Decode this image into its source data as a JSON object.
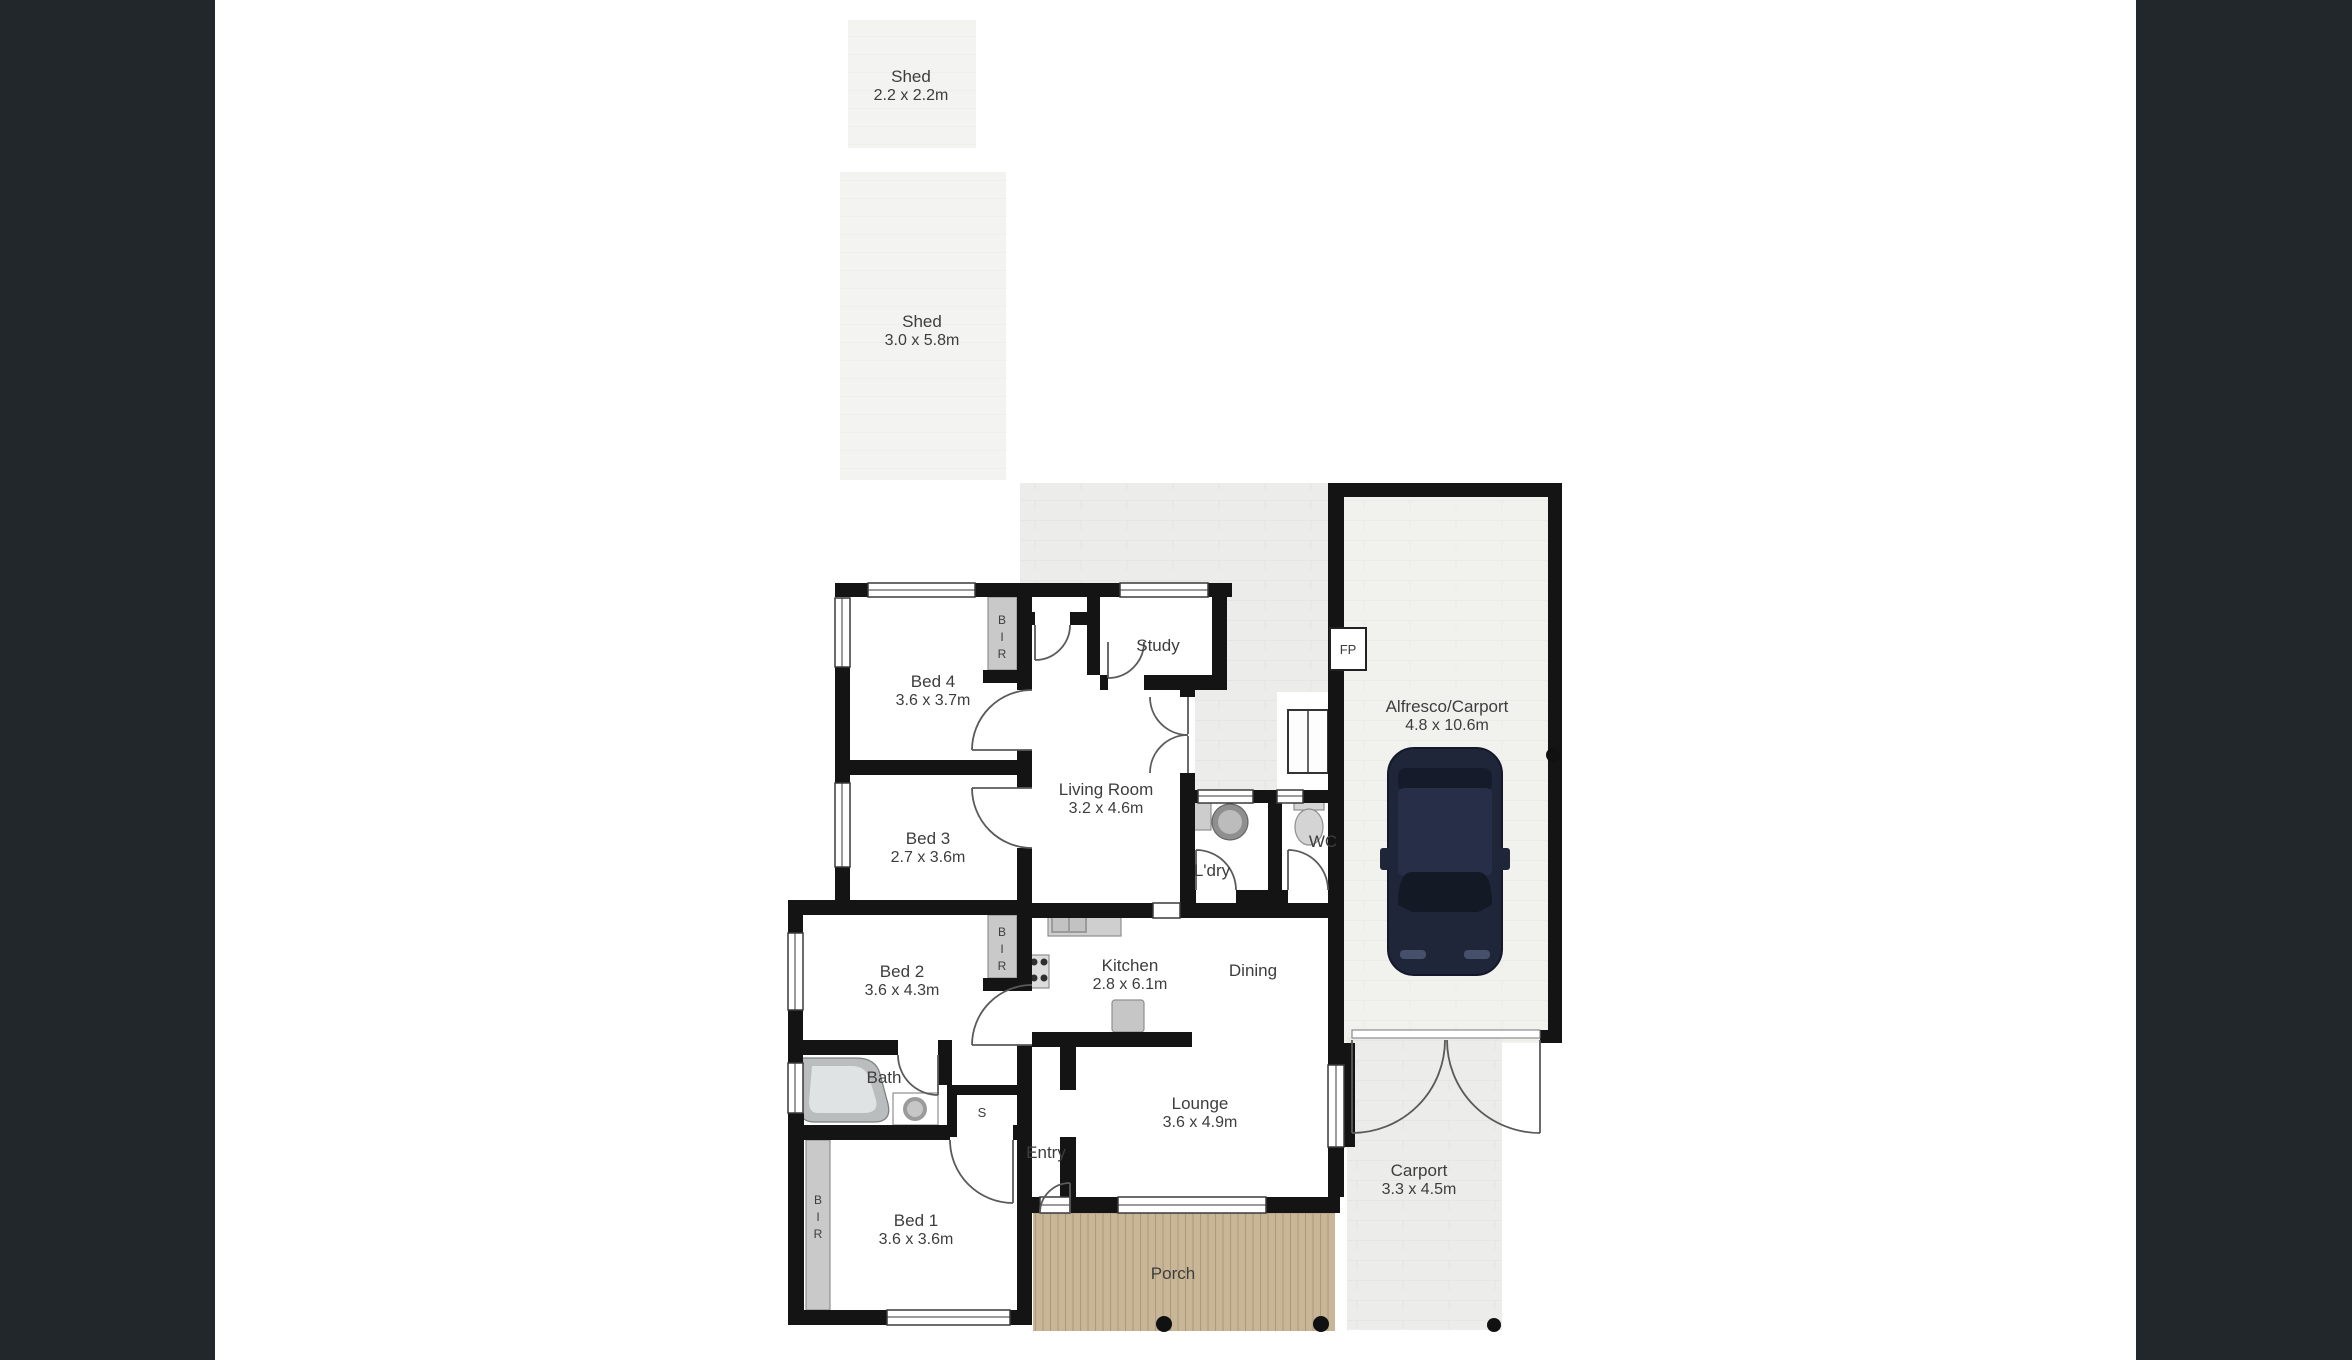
{
  "palette": {
    "sidebar": "#22272b",
    "wall": "#141414",
    "page": "#ffffff",
    "courtyard": "#ececea",
    "alfresco_floor": "#f1f1ee",
    "shed_floor": "#f3f3f1",
    "deck": "#c9b696",
    "deck_line": "#ae9d7f",
    "label_text": "#3d3d3d",
    "car_body": "#20263a"
  },
  "labels": {
    "shed_small": {
      "name": "Shed",
      "dims": "2.2 x 2.2m"
    },
    "shed_large": {
      "name": "Shed",
      "dims": "3.0 x 5.8m"
    },
    "bed1": {
      "name": "Bed 1",
      "dims": "3.6 x 3.6m"
    },
    "bed2": {
      "name": "Bed 2",
      "dims": "3.6 x 4.3m"
    },
    "bed3": {
      "name": "Bed 3",
      "dims": "2.7 x 3.6m"
    },
    "bed4": {
      "name": "Bed 4",
      "dims": "3.6 x 3.7m"
    },
    "study": {
      "name": "Study"
    },
    "living": {
      "name": "Living Room",
      "dims": "3.2 x 4.6m"
    },
    "kitchen": {
      "name": "Kitchen",
      "dims": "2.8 x 6.1m"
    },
    "dining": {
      "name": "Dining"
    },
    "lounge": {
      "name": "Lounge",
      "dims": "3.6 x 4.9m"
    },
    "bath": {
      "name": "Bath"
    },
    "ldry": {
      "name": "L'dry"
    },
    "wc": {
      "name": "WC"
    },
    "entry": {
      "name": "Entry"
    },
    "porch": {
      "name": "Porch"
    },
    "alfresco": {
      "name": "Alfresco/Carport",
      "dims": "4.8 x 10.6m"
    },
    "carport": {
      "name": "Carport",
      "dims": "3.3 x 4.5m"
    },
    "fp": "FP",
    "s": "S",
    "bir": [
      "B",
      "I",
      "R"
    ]
  }
}
